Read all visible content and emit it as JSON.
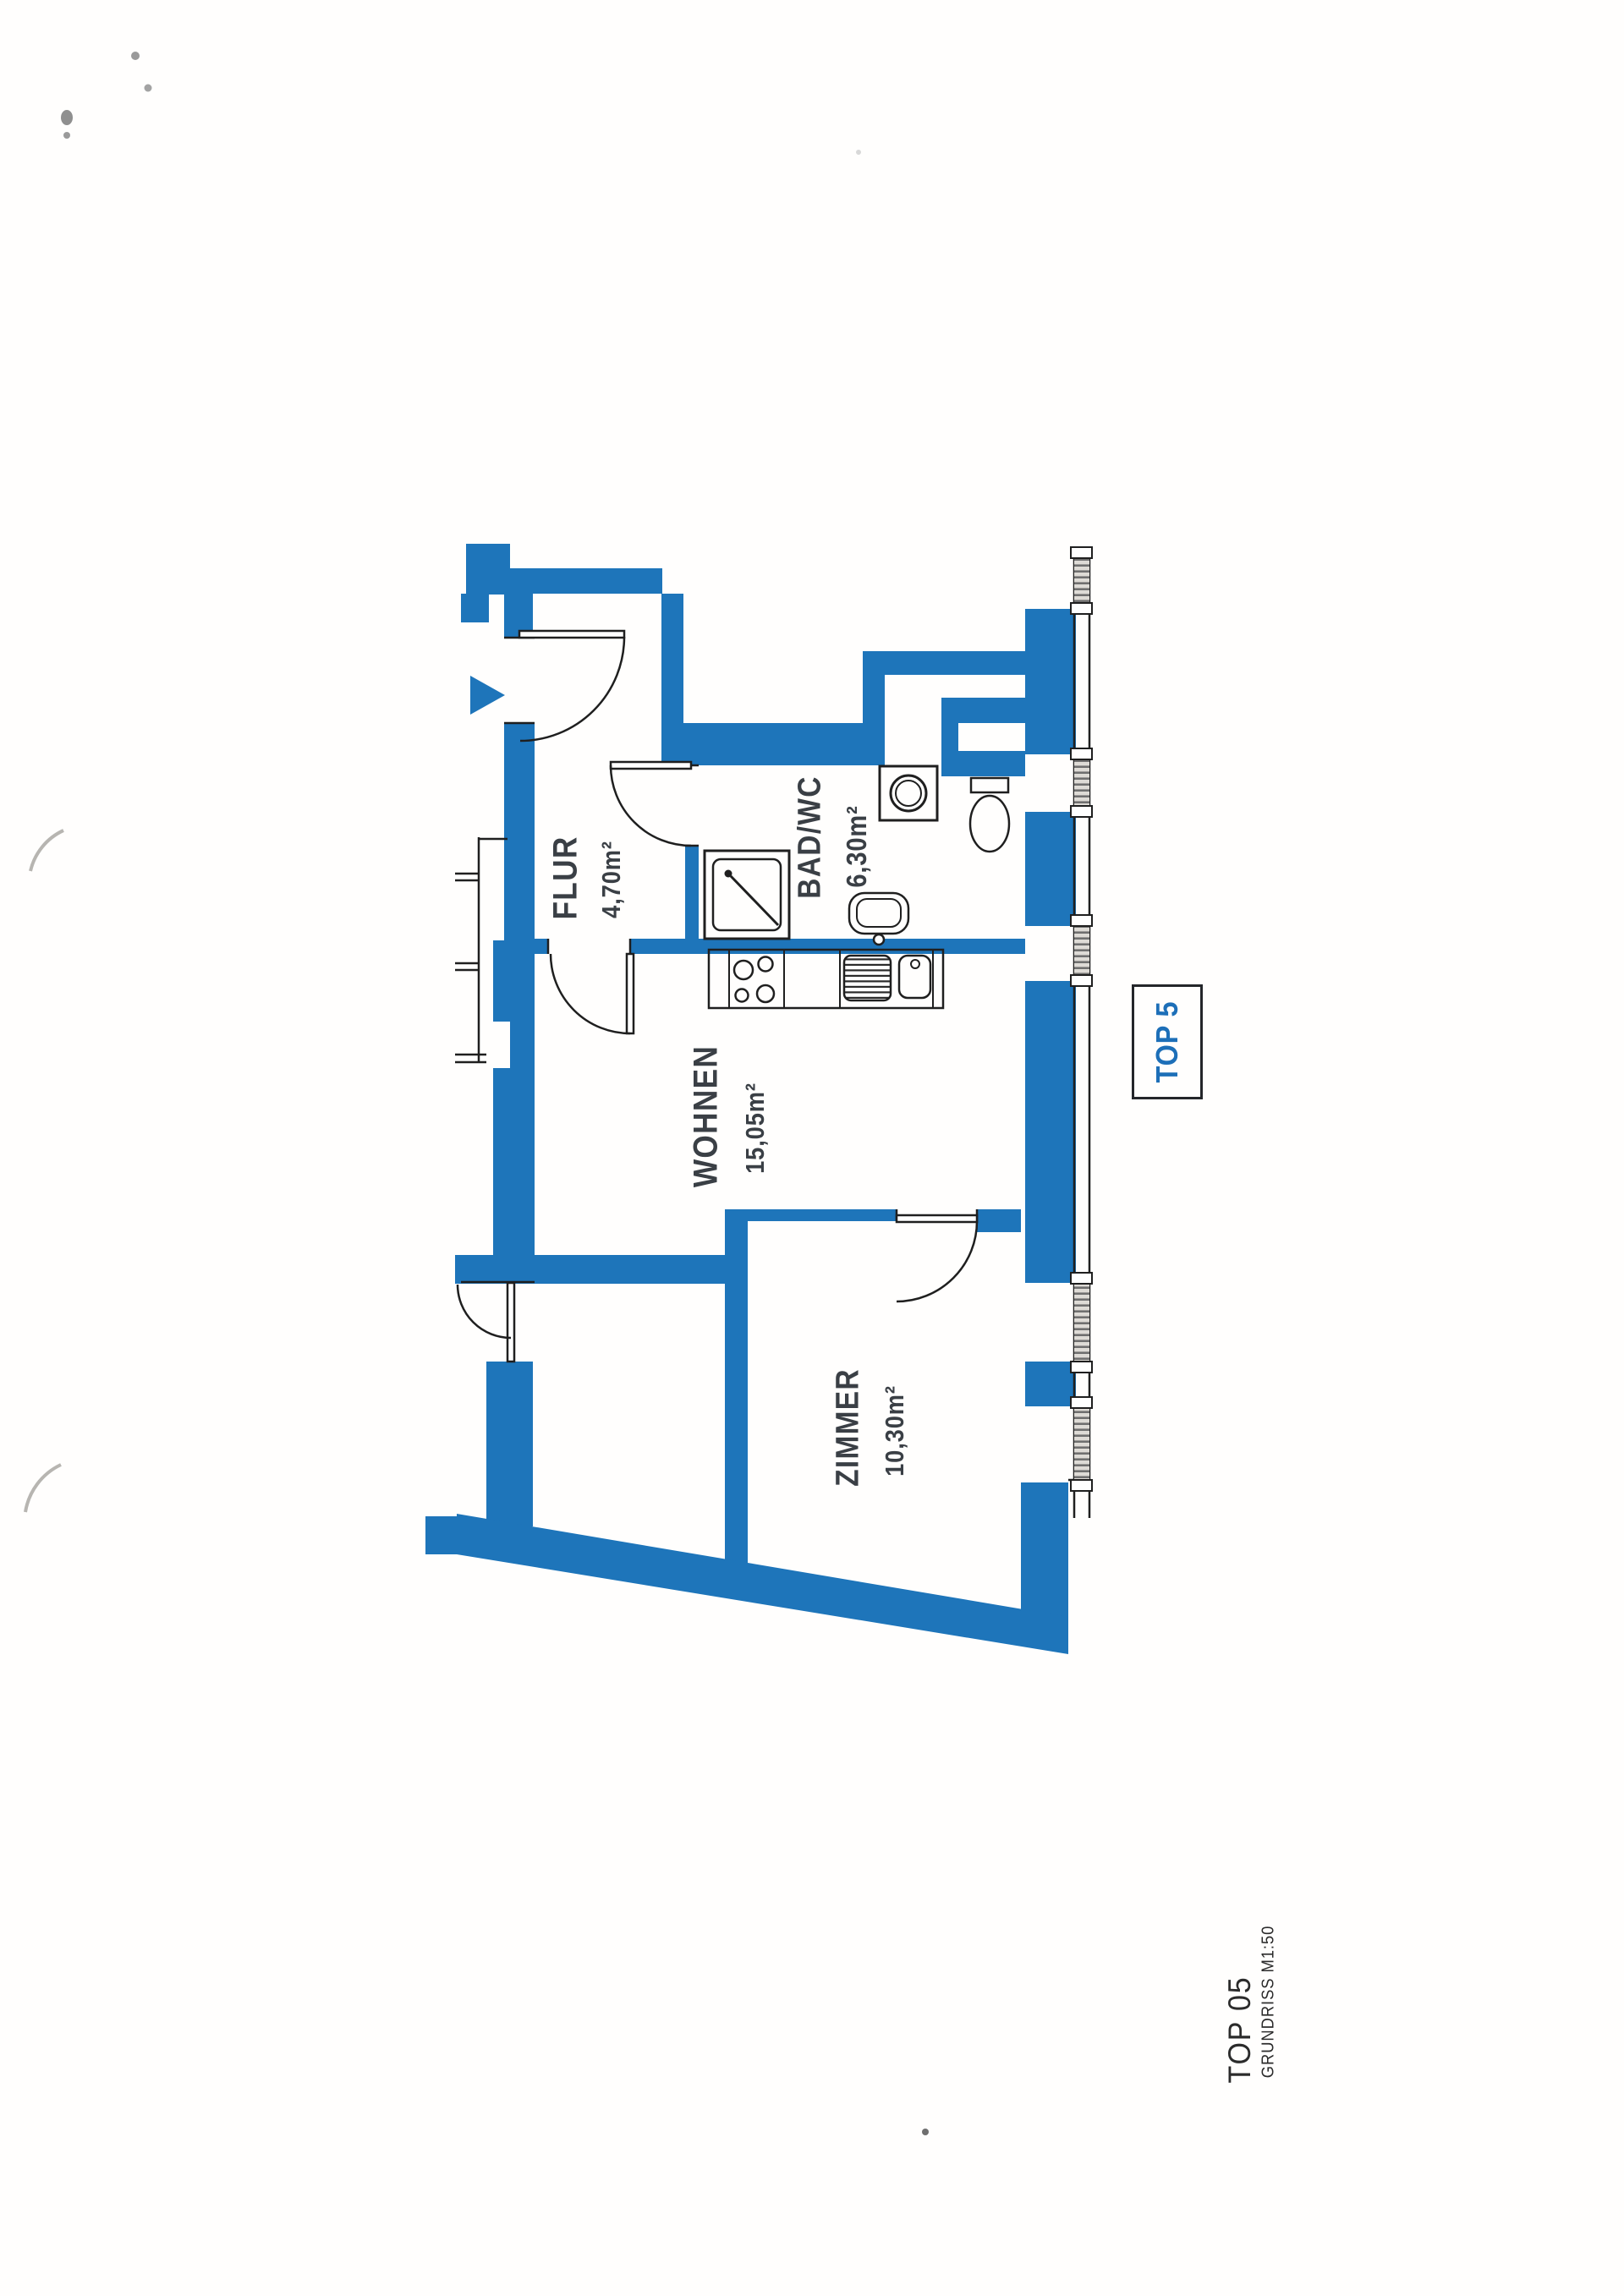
{
  "plan": {
    "rooms": [
      {
        "name": "FLUR",
        "area": "4,70m²"
      },
      {
        "name": "BAD/WC",
        "area": "6,30m²"
      },
      {
        "name": "WOHNEN",
        "area": "15,05m²"
      },
      {
        "name": "ZIMMER",
        "area": "10,30m²"
      }
    ],
    "unit_badge": "TOP 5"
  },
  "footer": {
    "unit": "TOP 05",
    "scale_note": "GRUNDRISS M1:50"
  },
  "colors": {
    "wall_blue": "#1e75ba",
    "badge_blue": "#1d6fb8",
    "label_dark": "#3a3f45",
    "line_black": "#1f1f1f"
  }
}
